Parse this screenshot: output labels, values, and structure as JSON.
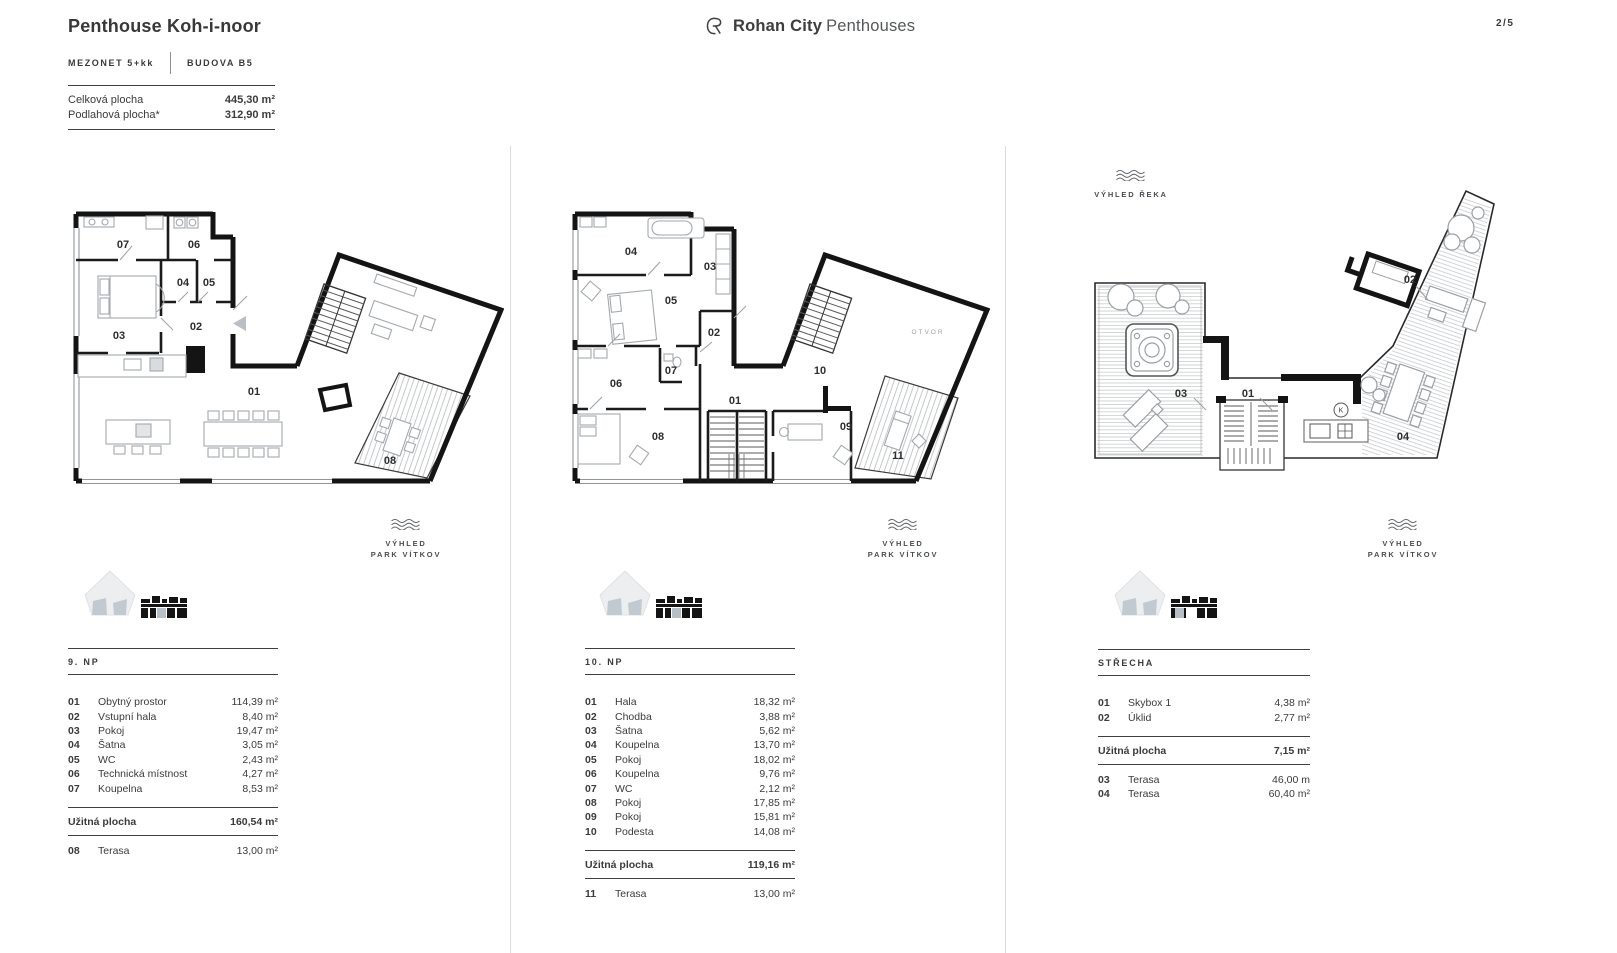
{
  "page_number": "2/5",
  "brand": {
    "name_bold": "Rohan City",
    "name_light": "Penthouses"
  },
  "header": {
    "title": "Penthouse Koh-i-noor",
    "tag_left": "MEZONET 5+kk",
    "tag_right": "BUDOVA B5",
    "summary": [
      {
        "label": "Celková plocha",
        "value": "445,30 m²"
      },
      {
        "label": "Podlahová plocha*",
        "value": "312,90 m²"
      }
    ]
  },
  "view_labels": {
    "park_line1": "VÝHLED",
    "park_line2": "PARK VÍTKOV",
    "river": "VÝHLED ŘEKA"
  },
  "floors": [
    {
      "name": "9. NP",
      "rooms": [
        {
          "num": "01",
          "name": "Obytný prostor",
          "value": "114,39 m²"
        },
        {
          "num": "02",
          "name": "Vstupní hala",
          "value": "8,40 m²"
        },
        {
          "num": "03",
          "name": "Pokoj",
          "value": "19,47 m²"
        },
        {
          "num": "04",
          "name": "Šatna",
          "value": "3,05 m²"
        },
        {
          "num": "05",
          "name": "WC",
          "value": "2,43 m²"
        },
        {
          "num": "06",
          "name": "Technická místnost",
          "value": "4,27 m²"
        },
        {
          "num": "07",
          "name": "Koupelna",
          "value": "8,53 m²"
        }
      ],
      "total_label": "Užitná plocha",
      "total_value": "160,54 m²",
      "extra": [
        {
          "num": "08",
          "name": "Terasa",
          "value": "13,00 m²"
        }
      ],
      "plan_labels": [
        "01",
        "02",
        "03",
        "04",
        "05",
        "06",
        "07",
        "08"
      ]
    },
    {
      "name": "10. NP",
      "rooms": [
        {
          "num": "01",
          "name": "Hala",
          "value": "18,32 m²"
        },
        {
          "num": "02",
          "name": "Chodba",
          "value": "3,88 m²"
        },
        {
          "num": "03",
          "name": "Šatna",
          "value": "5,62 m²"
        },
        {
          "num": "04",
          "name": "Koupelna",
          "value": "13,70 m²"
        },
        {
          "num": "05",
          "name": "Pokoj",
          "value": "18,02 m²"
        },
        {
          "num": "06",
          "name": "Koupelna",
          "value": "9,76 m²"
        },
        {
          "num": "07",
          "name": "WC",
          "value": "2,12 m²"
        },
        {
          "num": "08",
          "name": "Pokoj",
          "value": "17,85 m²"
        },
        {
          "num": "09",
          "name": "Pokoj",
          "value": "15,81 m²"
        },
        {
          "num": "10",
          "name": "Podesta",
          "value": "14,08 m²"
        }
      ],
      "total_label": "Užitná plocha",
      "total_value": "119,16 m²",
      "extra": [
        {
          "num": "11",
          "name": "Terasa",
          "value": "13,00 m²"
        }
      ],
      "plan_labels": [
        "01",
        "02",
        "03",
        "04",
        "05",
        "06",
        "07",
        "08",
        "09",
        "10",
        "11"
      ],
      "void_label": "OTVOR"
    },
    {
      "name": "STŘECHA",
      "rooms": [
        {
          "num": "01",
          "name": "Skybox 1",
          "value": "4,38 m²"
        },
        {
          "num": "02",
          "name": "Úklid",
          "value": "2,77 m²"
        }
      ],
      "total_label": "Užitná plocha",
      "total_value": "7,15 m²",
      "extra": [
        {
          "num": "03",
          "name": "Terasa",
          "value": "46,00 m"
        },
        {
          "num": "04",
          "name": "Terasa",
          "value": "60,40 m²"
        }
      ],
      "plan_labels": [
        "01",
        "02",
        "03",
        "04"
      ],
      "k_label": "K"
    }
  ]
}
